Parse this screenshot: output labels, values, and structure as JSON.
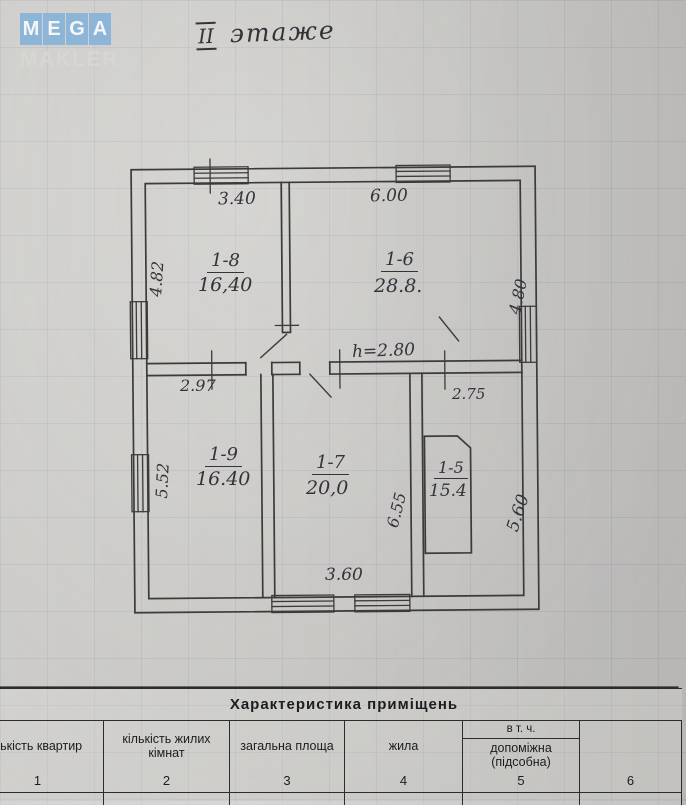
{
  "logo": {
    "tiles": [
      "M",
      "E",
      "G",
      "A"
    ],
    "makler": "MAKLER"
  },
  "floor": {
    "numeral": "II",
    "word": "этаже"
  },
  "plan": {
    "height_note": "h=2.80",
    "rooms": [
      {
        "id": "1-8",
        "area": "16,40"
      },
      {
        "id": "1-6",
        "area": "28.8."
      },
      {
        "id": "1-9",
        "area": "16.40"
      },
      {
        "id": "1-7",
        "area": "20,0"
      },
      {
        "id": "1-5",
        "area": "15.4"
      }
    ],
    "dimensions": {
      "room8_width": "3.40",
      "room8_height": "4.82",
      "room6_width": "6.00",
      "room6_height": "4.80",
      "room9_width": "2.97",
      "room9_height": "5.52",
      "room7_width": "3.60",
      "room7_height": "6.55",
      "room5_width": "2.75",
      "room5_height": "5.60"
    }
  },
  "table": {
    "title": "Характеристика  приміщень",
    "col1_header": "лькість квартир",
    "col2_header": "кількість жилих кімнат",
    "col3_header": "загальна площа",
    "col4_header": "жила",
    "col5_header_top": "в т. ч.",
    "col5_header": "допоміжна (підсобна)",
    "col6_header": "",
    "numbers": [
      "1",
      "2",
      "3",
      "4",
      "5",
      "6"
    ]
  }
}
